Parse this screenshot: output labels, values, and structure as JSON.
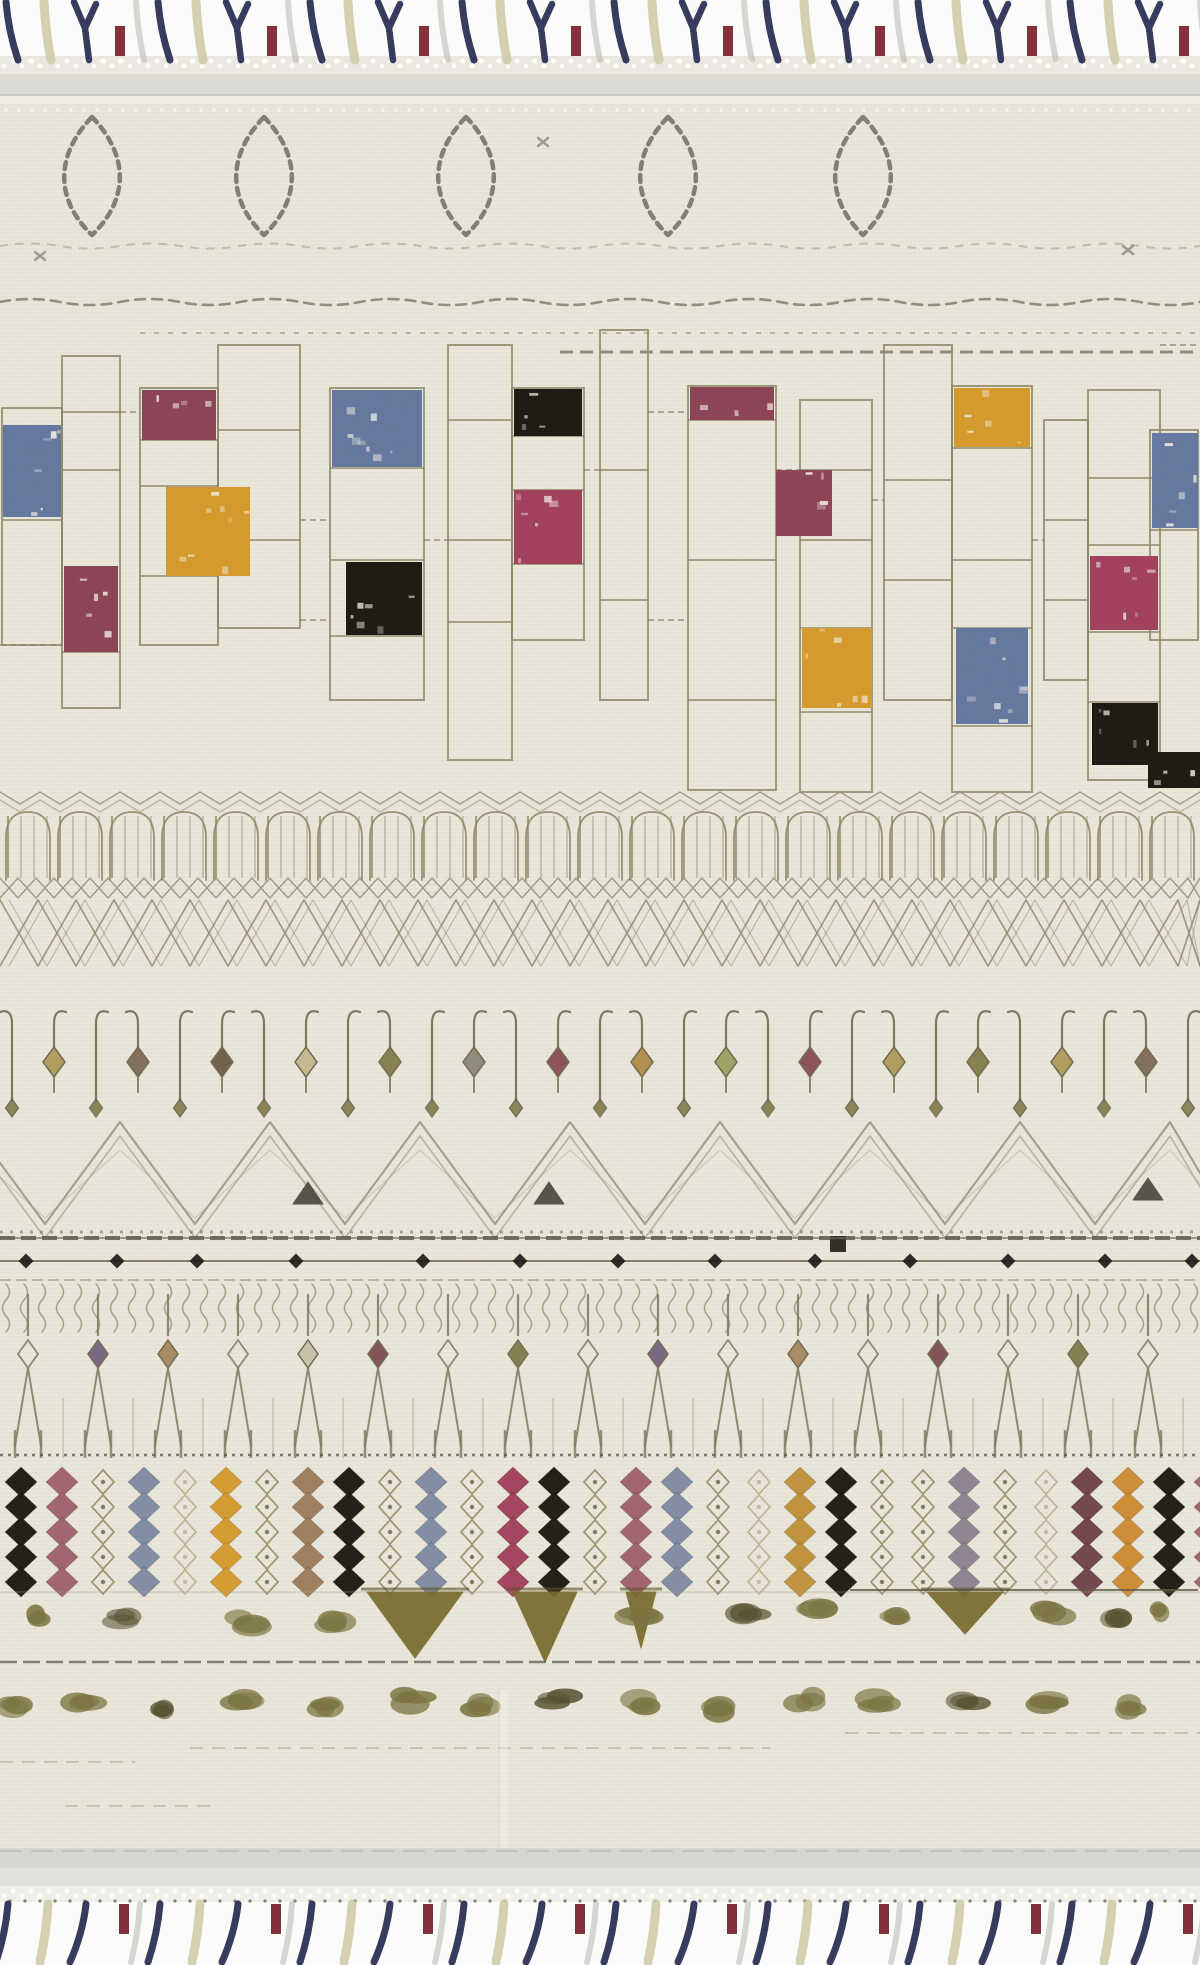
{
  "scene": {
    "subject": "cream moroccan-style tribal area rug with tassel fringe, full product photo",
    "orientation": "vertical"
  },
  "layout": {
    "width": 1200,
    "height": 1965,
    "body_top": 104,
    "body_bottom": 1848
  },
  "palette": {
    "fringe_bg": "#fbfbf9",
    "body": "#ebe8db",
    "band_light": "#dcdad4",
    "band_dark": "#c6c4bf",
    "outline": "#8a8464",
    "outline_dark": "#5f5b4b",
    "motif": "#8f8a70",
    "motif_dark": "#45423a",
    "blue": "#64779f",
    "maroon": "#8c4356",
    "maroon_bright": "#a23f5c",
    "mustard": "#d69a2b",
    "black": "#1b1812",
    "navy": "#2c3156",
    "red": "#7f2733",
    "khaki": "#cfc8a6",
    "grey_strand": "#bab7ae",
    "fleck": "#f2efe4",
    "olive": "#7a7340",
    "gold_dark": "#776a2c",
    "tan": "#9c7c5c",
    "rose": "#a0616e",
    "bluegrey": "#7f8ba3",
    "mauve": "#8d8292",
    "brown": "#70414a",
    "orange": "#cf8c31",
    "gold": "#c09238",
    "pale_outline": "#b5ae8e",
    "pendants": [
      "#ad9a58",
      "#7d6a55",
      "#6b5a44",
      "#c2b98f",
      "#827b48",
      "#8b8878",
      "#8a4a50",
      "#b08c48",
      "#9aa060",
      "#8a4a50",
      "#ad9a58",
      "#827b48"
    ],
    "fork_accents": {
      "purple": "#75617f",
      "tan": "#a5885e",
      "pale": "#c9c0a8",
      "maroon": "#7d4b50",
      "olive": "#7f7a45"
    }
  },
  "fringe": {
    "period": 152,
    "top": {
      "y1": 2,
      "y2": 60,
      "units": 8,
      "strands": [
        {
          "dx": 6,
          "t": "slash",
          "c": "navy",
          "lean": 12
        },
        {
          "dx": 44,
          "t": "slash",
          "c": "khaki",
          "lean": 7
        },
        {
          "dx": 80,
          "t": "y",
          "c": "navy",
          "lean": 0
        },
        {
          "dx": 120,
          "t": "short",
          "c": "red",
          "lean": 0
        },
        {
          "dx": 136,
          "t": "slash",
          "c": "grey_strand",
          "lean": 8
        }
      ]
    },
    "bottom": {
      "y1": 1904,
      "y2": 1962,
      "units": 8,
      "strands": [
        {
          "dx": 8,
          "t": "slash",
          "c": "navy",
          "lean": -12
        },
        {
          "dx": 48,
          "t": "slash",
          "c": "khaki",
          "lean": -8
        },
        {
          "dx": 86,
          "t": "slash",
          "c": "navy",
          "lean": -16
        },
        {
          "dx": 124,
          "t": "short",
          "c": "red",
          "lean": 0
        },
        {
          "dx": 140,
          "t": "slash",
          "c": "grey_strand",
          "lean": -9
        }
      ]
    }
  },
  "diamonds": {
    "y": 176,
    "rx": 39,
    "ry": 59,
    "centers": [
      92,
      264,
      466,
      668,
      863
    ],
    "marks": [
      [
        543,
        142
      ],
      [
        40,
        256
      ],
      [
        1128,
        250
      ]
    ]
  },
  "grid": {
    "columns": [
      {
        "x": 2,
        "w": 60,
        "y": 408,
        "h": 237,
        "div": [
          520
        ]
      },
      {
        "x": 62,
        "w": 58,
        "y": 356,
        "h": 352,
        "div": [
          412,
          470,
          652
        ]
      },
      {
        "x": 140,
        "w": 78,
        "y": 388,
        "h": 257,
        "div": [
          440,
          486,
          576
        ]
      },
      {
        "x": 218,
        "w": 82,
        "y": 345,
        "h": 283,
        "div": [
          430,
          540
        ]
      },
      {
        "x": 330,
        "w": 94,
        "y": 388,
        "h": 312,
        "div": [
          468,
          560,
          636
        ]
      },
      {
        "x": 448,
        "w": 64,
        "y": 345,
        "h": 415,
        "div": [
          420,
          540,
          622
        ]
      },
      {
        "x": 512,
        "w": 72,
        "y": 388,
        "h": 252,
        "div": [
          436,
          490,
          564
        ]
      },
      {
        "x": 600,
        "w": 48,
        "y": 330,
        "h": 370,
        "div": [
          470,
          600
        ]
      },
      {
        "x": 688,
        "w": 88,
        "y": 386,
        "h": 404,
        "div": [
          420,
          560,
          700
        ]
      },
      {
        "x": 800,
        "w": 72,
        "y": 400,
        "h": 392,
        "div": [
          470,
          540,
          628,
          712
        ]
      },
      {
        "x": 884,
        "w": 68,
        "y": 345,
        "h": 355,
        "div": [
          480,
          580
        ]
      },
      {
        "x": 952,
        "w": 80,
        "y": 386,
        "h": 406,
        "div": [
          448,
          560,
          628,
          726
        ]
      },
      {
        "x": 1044,
        "w": 44,
        "y": 420,
        "h": 260,
        "div": [
          520,
          600
        ]
      },
      {
        "x": 1088,
        "w": 72,
        "y": 390,
        "h": 390,
        "div": [
          478,
          545,
          632,
          702
        ]
      },
      {
        "x": 1150,
        "w": 48,
        "y": 430,
        "h": 210,
        "div": [
          530
        ]
      }
    ],
    "hlinks": [
      [
        120,
        140,
        412
      ],
      [
        0,
        62,
        645
      ],
      [
        300,
        330,
        520
      ],
      [
        424,
        448,
        540
      ],
      [
        584,
        600,
        470
      ],
      [
        648,
        688,
        412
      ],
      [
        776,
        800,
        470
      ],
      [
        872,
        884,
        500
      ],
      [
        1032,
        1044,
        540
      ],
      [
        648,
        688,
        620
      ],
      [
        1160,
        1198,
        345
      ],
      [
        300,
        330,
        620
      ]
    ],
    "blocks": [
      {
        "x": 3,
        "y": 425,
        "w": 58,
        "h": 92,
        "c": "blue"
      },
      {
        "x": 64,
        "y": 566,
        "w": 54,
        "h": 86,
        "c": "maroon"
      },
      {
        "x": 142,
        "y": 390,
        "w": 74,
        "h": 50,
        "c": "maroon"
      },
      {
        "x": 166,
        "y": 487,
        "w": 84,
        "h": 89,
        "c": "mustard"
      },
      {
        "x": 332,
        "y": 390,
        "w": 90,
        "h": 77,
        "c": "blue"
      },
      {
        "x": 346,
        "y": 562,
        "w": 76,
        "h": 73,
        "c": "black"
      },
      {
        "x": 514,
        "y": 389,
        "w": 68,
        "h": 47,
        "c": "black"
      },
      {
        "x": 514,
        "y": 490,
        "w": 68,
        "h": 74,
        "c": "maroon_bright"
      },
      {
        "x": 690,
        "y": 387,
        "w": 84,
        "h": 33,
        "c": "maroon"
      },
      {
        "x": 776,
        "y": 470,
        "w": 56,
        "h": 66,
        "c": "maroon"
      },
      {
        "x": 802,
        "y": 628,
        "w": 70,
        "h": 80,
        "c": "mustard"
      },
      {
        "x": 954,
        "y": 388,
        "w": 76,
        "h": 59,
        "c": "mustard"
      },
      {
        "x": 956,
        "y": 628,
        "w": 72,
        "h": 96,
        "c": "blue"
      },
      {
        "x": 1090,
        "y": 556,
        "w": 68,
        "h": 74,
        "c": "maroon_bright"
      },
      {
        "x": 1092,
        "y": 703,
        "w": 66,
        "h": 62,
        "c": "black"
      },
      {
        "x": 1152,
        "y": 433,
        "w": 46,
        "h": 95,
        "c": "blue"
      },
      {
        "x": 1148,
        "y": 752,
        "w": 52,
        "h": 36,
        "c": "black"
      }
    ]
  },
  "hooks": {
    "stem_x0": 12,
    "stem_step": 42,
    "count": 29,
    "black_triangles": [
      [
        308,
        1204
      ],
      [
        549,
        1204
      ],
      [
        1148,
        1200
      ]
    ],
    "squares": [
      [
        830,
        1236
      ]
    ]
  },
  "weave": {
    "dots_x": [
      26,
      117,
      197,
      296,
      423,
      520,
      618,
      715,
      815,
      910,
      1008,
      1105,
      1192
    ],
    "forks": {
      "colors": [
        "outline",
        "purple",
        "tan",
        "outline",
        "pale",
        "maroon",
        "outline",
        "olive",
        "outline",
        "purple",
        "outline",
        "tan",
        "outline",
        "maroon",
        "outline",
        "olive",
        "outline"
      ]
    }
  },
  "beads": {
    "x0": 6,
    "pitch": 41,
    "cols": [
      "black",
      "rose",
      "o",
      "bluegrey",
      "op",
      "mustard",
      "o",
      "tan",
      "black",
      "o",
      "bluegrey",
      "o",
      "maroon_bright",
      "black",
      "o",
      "rose",
      "bluegrey",
      "o",
      "op",
      "gold",
      "black",
      "o",
      "o",
      "mauve",
      "o",
      "op",
      "brown",
      "orange",
      "black",
      "rose"
    ]
  },
  "triangles": {
    "y": 1592,
    "line_y": 1662,
    "solid": [
      {
        "cx": 415,
        "w": 96,
        "h": 66
      },
      {
        "cx": 545,
        "w": 64,
        "h": 70
      },
      {
        "cx": 641,
        "w": 30,
        "h": 56
      },
      {
        "cx": 965,
        "w": 76,
        "h": 42
      }
    ],
    "blobs": [
      [
        38,
        1618,
        26
      ],
      [
        123,
        1620,
        40
      ],
      [
        249,
        1622,
        44
      ],
      [
        329,
        1624,
        40
      ],
      [
        650,
        1612,
        54
      ],
      [
        751,
        1616,
        42
      ],
      [
        822,
        1610,
        46
      ],
      [
        894,
        1618,
        30
      ],
      [
        1055,
        1612,
        46
      ],
      [
        1116,
        1620,
        30
      ],
      [
        1162,
        1614,
        22
      ]
    ]
  },
  "blob_row": [
    [
      17,
      1706,
      34
    ],
    [
      85,
      1700,
      44
    ],
    [
      164,
      1712,
      30
    ],
    [
      243,
      1702,
      42
    ],
    [
      323,
      1708,
      34
    ],
    [
      407,
      1700,
      43
    ],
    [
      478,
      1706,
      38
    ],
    [
      560,
      1700,
      49
    ],
    [
      642,
      1704,
      40
    ],
    [
      724,
      1708,
      36
    ],
    [
      806,
      1700,
      34
    ],
    [
      884,
      1702,
      46
    ],
    [
      968,
      1706,
      38
    ],
    [
      1052,
      1700,
      44
    ],
    [
      1133,
      1708,
      32
    ]
  ],
  "faint_lines": [
    [
      845,
      1200,
      1733
    ],
    [
      190,
      770,
      1748
    ],
    [
      0,
      135,
      1762
    ],
    [
      65,
      210,
      1806
    ]
  ]
}
